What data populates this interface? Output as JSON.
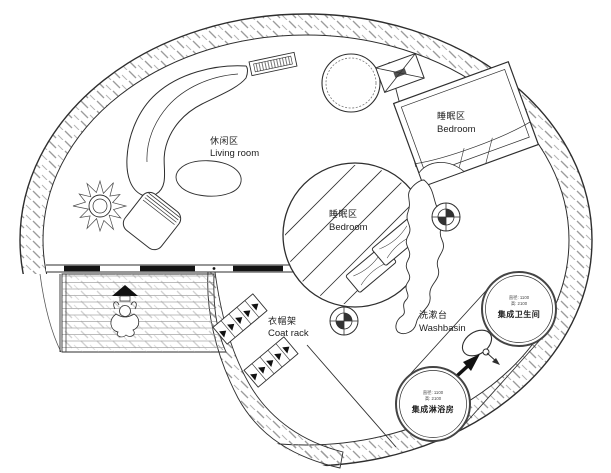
{
  "plan": {
    "title": "circular-house-floor-plan",
    "areas": {
      "living_room": {
        "zh": "休闲区",
        "en": "Living room"
      },
      "bedroom_right": {
        "zh": "睡眠区",
        "en": "Bedroom"
      },
      "bedroom_center": {
        "zh": "睡眠区",
        "en": "Bedroom"
      },
      "coat_rack": {
        "zh": "衣帽架",
        "en": "Coat rack"
      },
      "washbasin": {
        "zh": "洗漱台",
        "en": "Washbasin"
      },
      "bathroom_pod": {
        "dim1": "直径: 1100",
        "dim2": "高: 2100",
        "name": "集成卫生间"
      },
      "shower_pod": {
        "dim1": "直径: 1100",
        "dim2": "高: 2100",
        "name": "集成淋浴房"
      }
    },
    "colors": {
      "line": "#2e2e2e",
      "hatch": "#9b9b9b",
      "glazing": "#141414",
      "background": "#ffffff"
    }
  }
}
